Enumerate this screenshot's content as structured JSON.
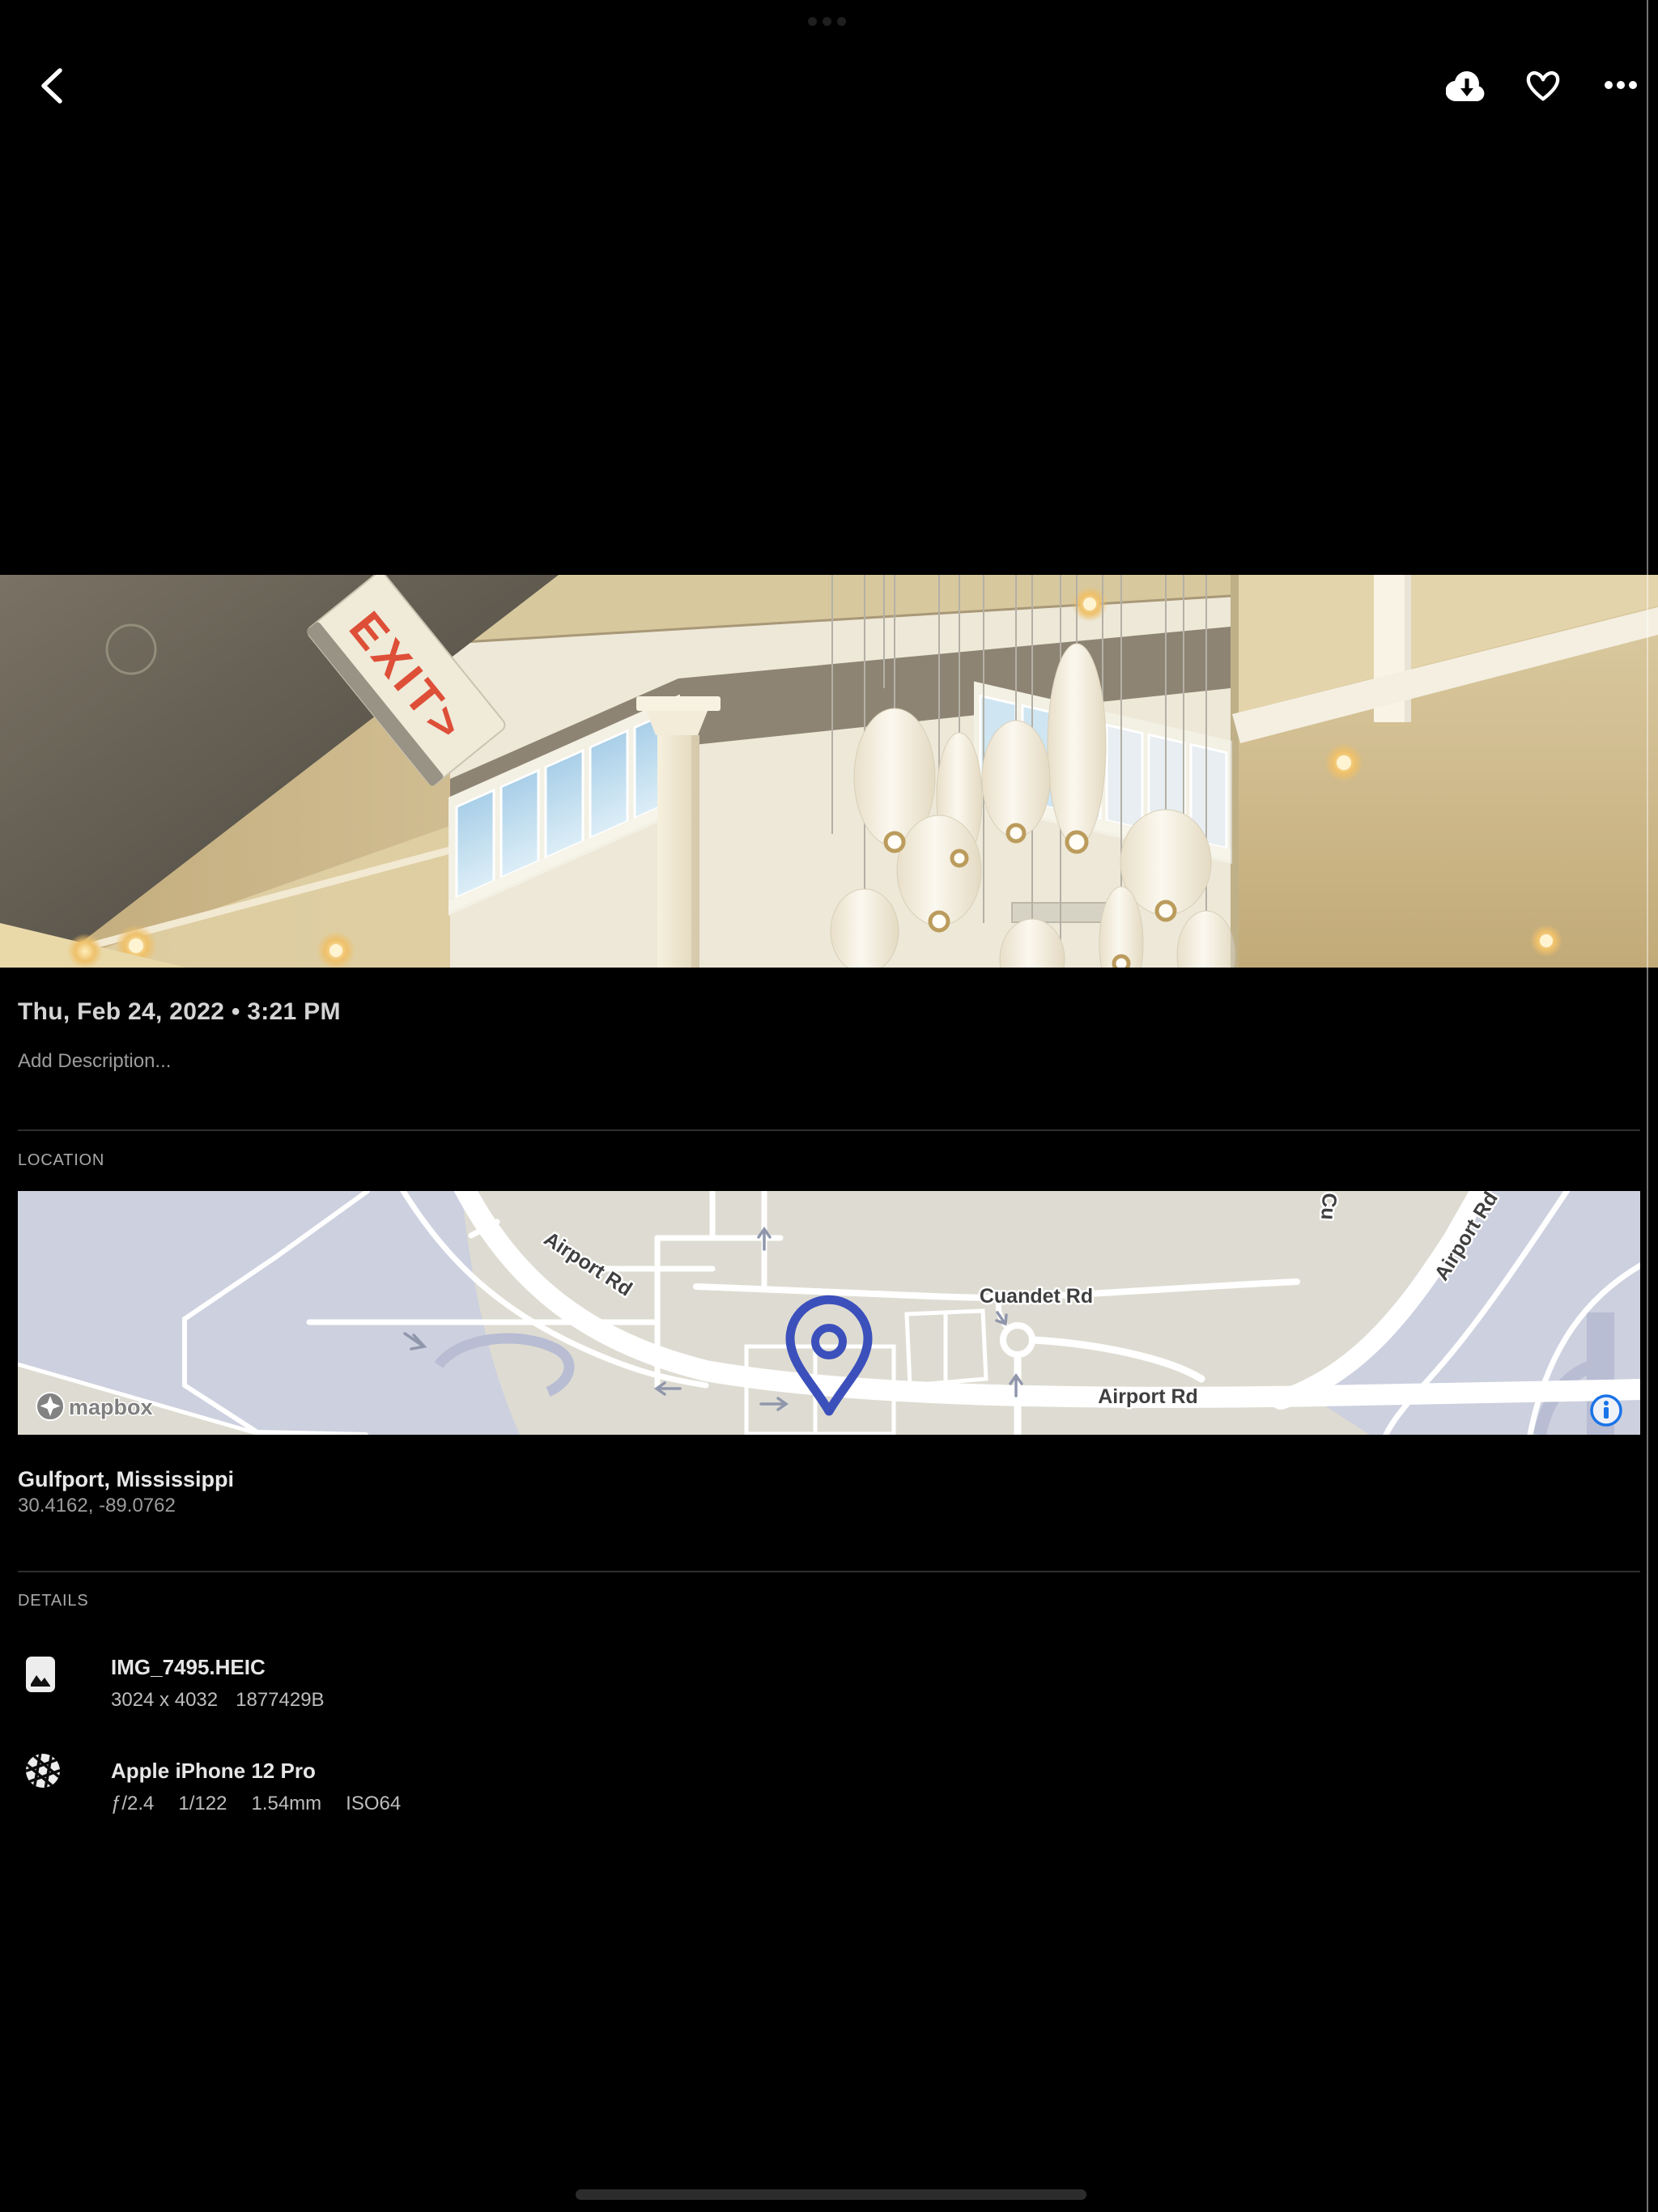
{
  "status_bar": {
    "multitask_indicator_icon": "ellipsis-horizontal"
  },
  "top_bar": {
    "back_icon": "chevron-left",
    "download_icon": "cloud-download",
    "favorite_icon": "heart-outline",
    "more_icon": "ellipsis-horizontal"
  },
  "photo": {
    "exit_sign": "EXIT>"
  },
  "details_panel": {
    "date_time": "Thu, Feb 24, 2022 • 3:21 PM",
    "description_placeholder": "Add Description...",
    "location_section": {
      "title": "LOCATION",
      "map": {
        "attribution": "mapbox",
        "labels": {
          "airport_rd_upper": "Airport Rd",
          "cuandet_rd": "Cuandet Rd",
          "airport_rd_lower": "Airport Rd",
          "airport_rd_right": "Airport Rd",
          "road_fragment_top": "Cu"
        },
        "pin_icon": "map-pin",
        "info_icon": "info-circle",
        "pin_color": "#3c50bc",
        "info_color": "#1a73e8",
        "land_color": "#dedcd2",
        "area_color": "#ccd0df"
      },
      "place": "Gulfport, Mississippi",
      "coordinates": "30.4162, -89.0762"
    },
    "details_section": {
      "title": "DETAILS",
      "file": {
        "icon": "image",
        "name": "IMG_7495.HEIC",
        "dimensions": "3024 x 4032",
        "size_bytes": "1877429B"
      },
      "camera": {
        "icon": "camera-iris",
        "name": "Apple iPhone 12 Pro",
        "aperture": "ƒ/2.4",
        "shutter_speed": "1/122",
        "focal_length": "1.54mm",
        "iso": "ISO64"
      }
    }
  }
}
